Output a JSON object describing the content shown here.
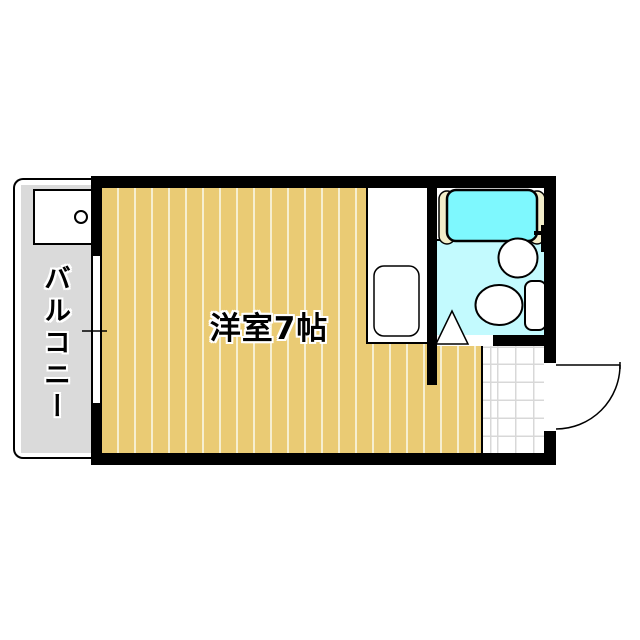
{
  "floor_plan": {
    "rooms": {
      "main_room": {
        "label": "洋室7帖"
      },
      "balcony": {
        "label": "バルコニー"
      }
    },
    "fixture_icons": [
      "bathtub-icon",
      "wash-basin-icon",
      "toilet-icon",
      "bath-door-triangle-icon",
      "kitchen-sink-icon",
      "washing-machine-pan-icon",
      "entrance-door-swing-icon",
      "sliding-window-icon",
      "floor-drain-icon"
    ],
    "colors": {
      "wall": "#000000",
      "flooring": "#EACB74",
      "flooring_stripe": "#F6EFD0",
      "balcony_floor": "#DADADA",
      "bathtub": "#7EF8FE",
      "bathtub_ledge": "#F2EDC9",
      "bathroom_floor": "#C3FAFE",
      "tile_line": "#D8D8D8"
    }
  }
}
